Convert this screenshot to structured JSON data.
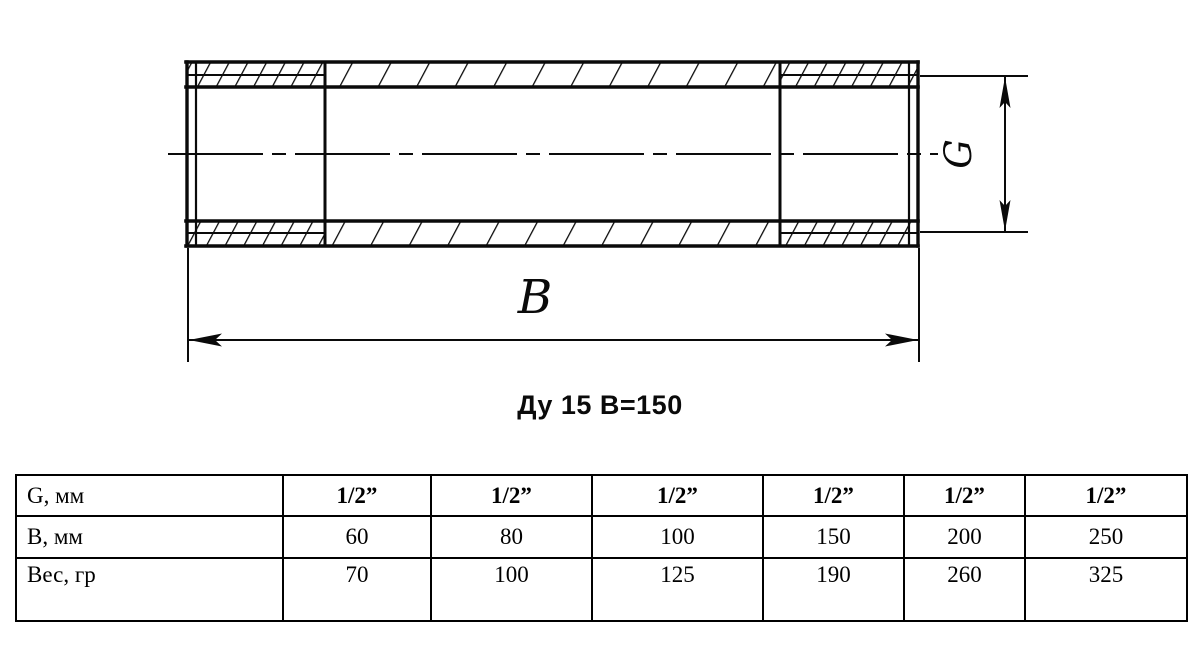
{
  "drawing": {
    "caption": "Ду 15 В=150",
    "length_dim_label": "B",
    "thread_dim_label": "G"
  },
  "table": {
    "rows": [
      {
        "label": "G, мм",
        "values": [
          "1/2”",
          "1/2”",
          "1/2”",
          "1/2”",
          "1/2”",
          "1/2”"
        ]
      },
      {
        "label": "В, мм",
        "values": [
          "60",
          "80",
          "100",
          "150",
          "200",
          "250"
        ]
      },
      {
        "label": "Вес, гр",
        "values": [
          "70",
          "100",
          "125",
          "190",
          "260",
          "325"
        ]
      }
    ]
  },
  "colors": {
    "line": "#0a0a0a",
    "background": "#ffffff"
  }
}
